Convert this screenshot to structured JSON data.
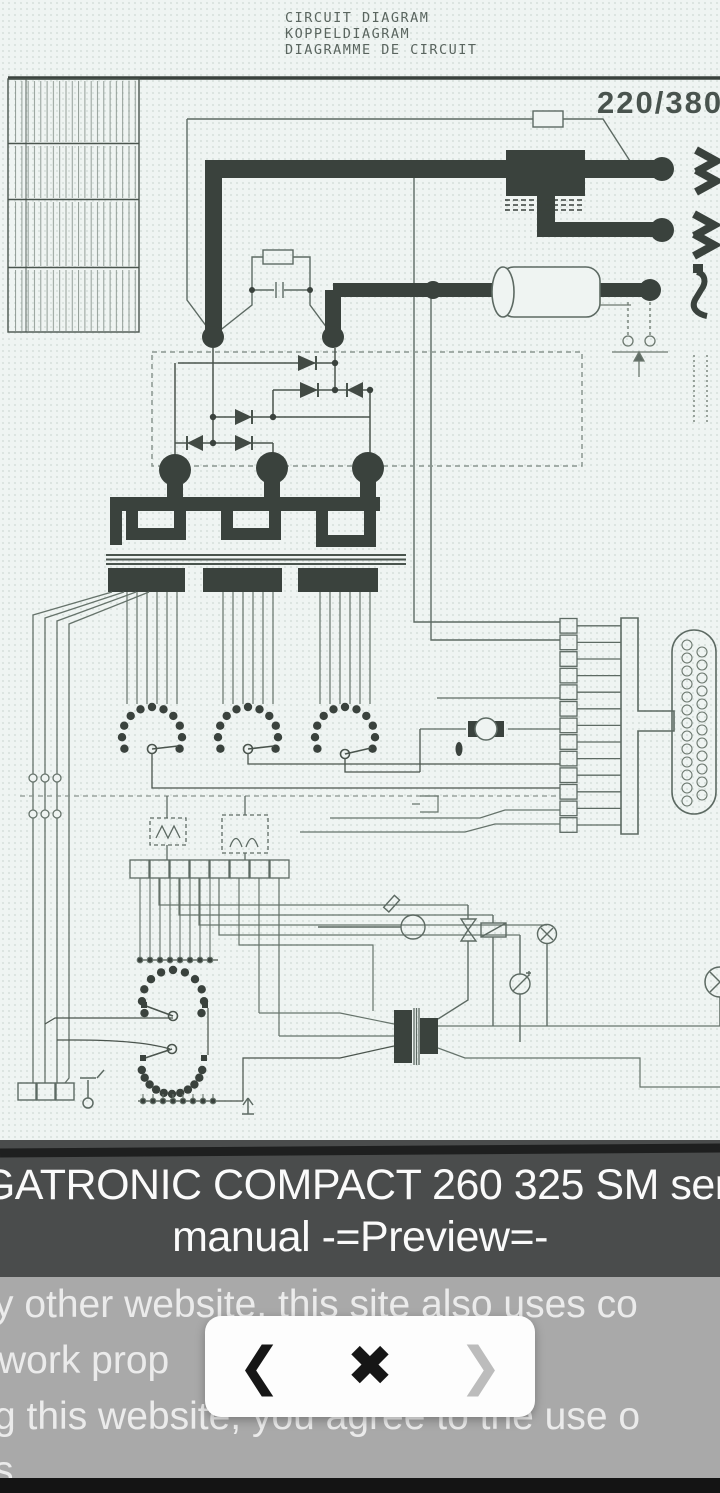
{
  "scan": {
    "header_lines": [
      "CIRCUIT DIAGRAM",
      "KOPPELDIAGRAM",
      "DIAGRAMME DE CIRCUIT"
    ],
    "voltage_label": "220/380"
  },
  "title_bar": {
    "line1": "IGATRONIC COMPACT 260 325 SM serv",
    "line2": "manual -=Preview=-"
  },
  "cookie_banner": {
    "lines": [
      "y other website, this site also uses co",
      "work prop",
      "g this website, you agree to the use o",
      "s."
    ]
  },
  "nav": {
    "prev_glyph": "❮",
    "close_glyph": "✖",
    "next_glyph": "❯"
  },
  "colors": {
    "diagram_ink": "#3a423d",
    "diagram_line": "#5d6a63",
    "page_bg": "#eff4f2",
    "title_bar_bg": "#4a4c4c",
    "title_stripe": "#1e1f1f",
    "title_text": "#fafafa",
    "cookie_bg": "#a9a9a9",
    "cookie_text": "#ebebeb",
    "panel_bg": "#fdfdfd",
    "nav_active": "#161616",
    "nav_disabled": "#bcbcbc",
    "bottom_bar": "#141414"
  }
}
